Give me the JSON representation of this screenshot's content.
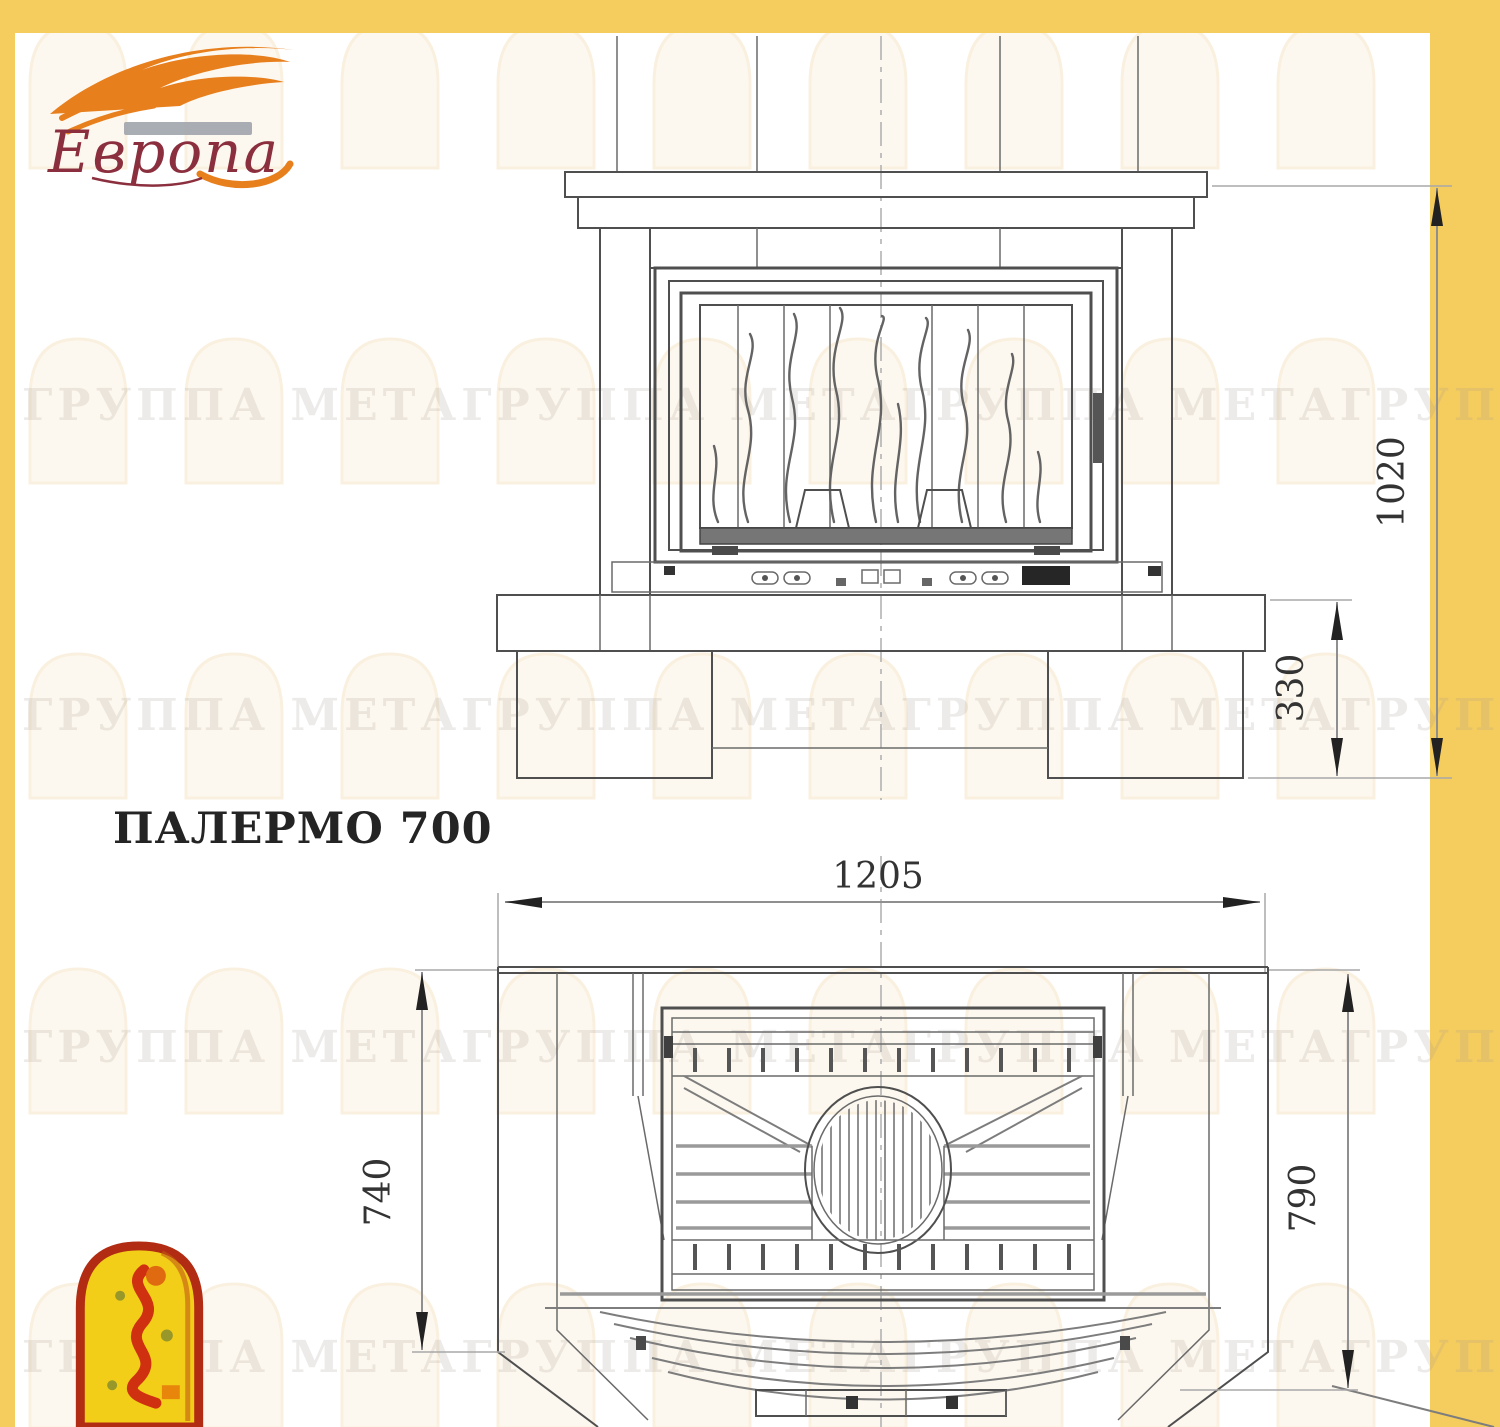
{
  "document": {
    "title": "ПАЛЕРМО 700"
  },
  "brand": {
    "logo_text": "Европа"
  },
  "watermark": {
    "row_text": "ГРУППА МЕТАГРУППА МЕТАГРУППА МЕТАГРУППА МЕТА"
  },
  "drawing": {
    "front_view": {
      "dim_height_total": "1020",
      "dim_base_height": "330"
    },
    "plan_view": {
      "dim_width": "1205",
      "dim_depth_side": "740",
      "dim_depth_total": "790"
    }
  },
  "icons": {
    "logo_flame": "flame-swoosh-icon",
    "brand_emblem": "arch-figure-icon"
  },
  "colors": {
    "frame": "#f5cc5e",
    "paper": "#ffffff",
    "line_dark": "#4f4f4f",
    "line_gray": "#8f8f8f",
    "dim_text": "#333333",
    "logo_orange": "#e87f1d",
    "logo_maroon": "#8b2f3e",
    "emblem_red": "#b12c12",
    "emblem_yellow": "#f2ce18",
    "watermark_arch": "#f6e3c4",
    "watermark_text": "#a99f94"
  }
}
